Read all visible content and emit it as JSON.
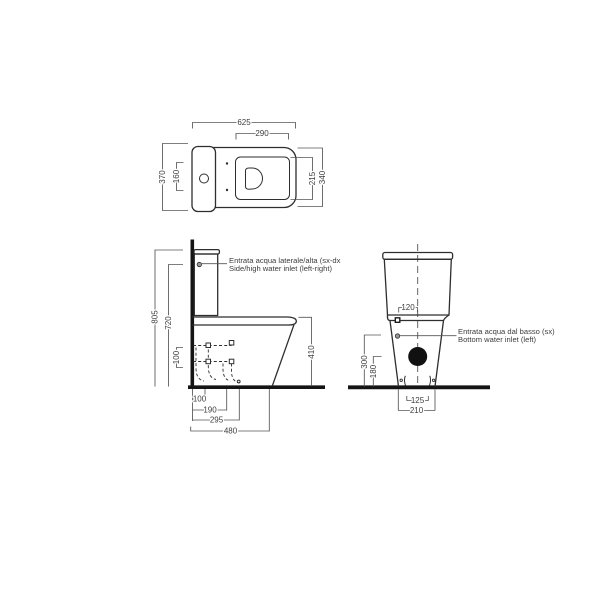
{
  "drawing": {
    "title": "toilet-technical-drawing",
    "annotations": {
      "side_inlet_it": "Entrata acqua laterale/alta (sx-dx",
      "side_inlet_en": "Side/high water inlet (left-right)",
      "bottom_inlet_it": "Entrata acqua dal basso (sx)",
      "bottom_inlet_en": "Bottom water inlet (left)"
    },
    "dimensions": {
      "top": {
        "overall_width": "625",
        "seat_opening_width": "290",
        "overall_depth": "370",
        "tank_span": "160",
        "opening_depth": "215",
        "seat_depth": "340"
      },
      "side": {
        "overall_height": "805",
        "inlet_height": "720",
        "pipe_spacing": "100",
        "bowl_height": "410",
        "chain_1": "100",
        "chain_2": "190",
        "chain_3": "295",
        "chain_4": "480"
      },
      "front": {
        "inlet_offset": "120",
        "side_inlet_height": "300",
        "drain_height": "180",
        "fixing_span": "125",
        "base_width": "210"
      }
    },
    "colors": {
      "outline": "#2e2e2e",
      "dimension": "#555555",
      "thick": "#141414",
      "text": "#3d3d3d",
      "drain_fill": "#111111",
      "background": "#ffffff"
    }
  }
}
